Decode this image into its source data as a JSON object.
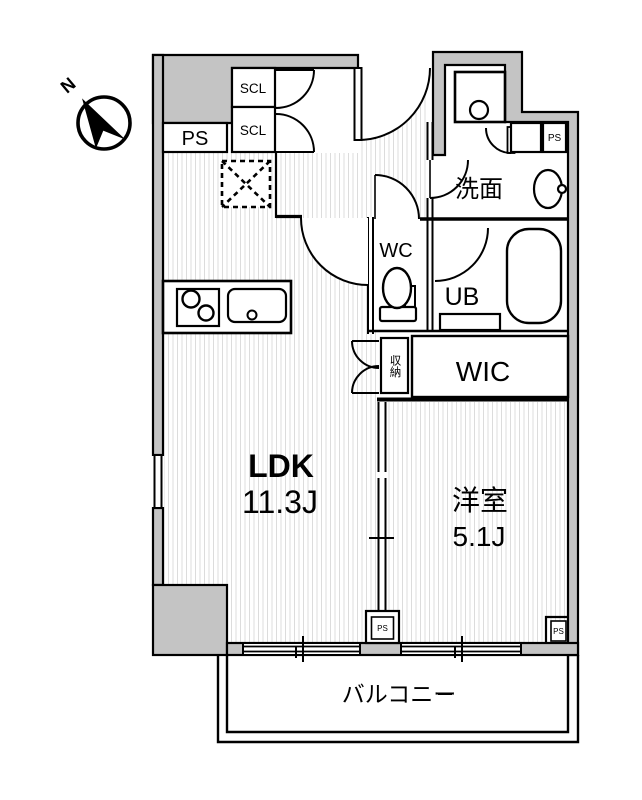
{
  "floorplan": {
    "compass_label": "N",
    "rooms": {
      "ldk": {
        "name": "LDK",
        "size": "11.3J"
      },
      "bedroom": {
        "name": "洋室",
        "size": "5.1J"
      },
      "balcony": {
        "name": "バルコニー"
      },
      "washroom": {
        "name": "洗面"
      },
      "toilet": {
        "name": "WC"
      },
      "bath": {
        "name": "UB"
      },
      "wic": {
        "name": "WIC"
      },
      "storage": {
        "name": "収納"
      }
    },
    "labels": {
      "ps_top_left": "PS",
      "ps_top_right": "PS",
      "ps_bottom_center": "PS",
      "ps_bottom_right": "PS",
      "scl_upper": "SCL",
      "scl_lower": "SCL"
    },
    "colors": {
      "wall_fill": "#c4c4c4",
      "line": "#000000",
      "hatch": "#dcdcdc"
    }
  }
}
